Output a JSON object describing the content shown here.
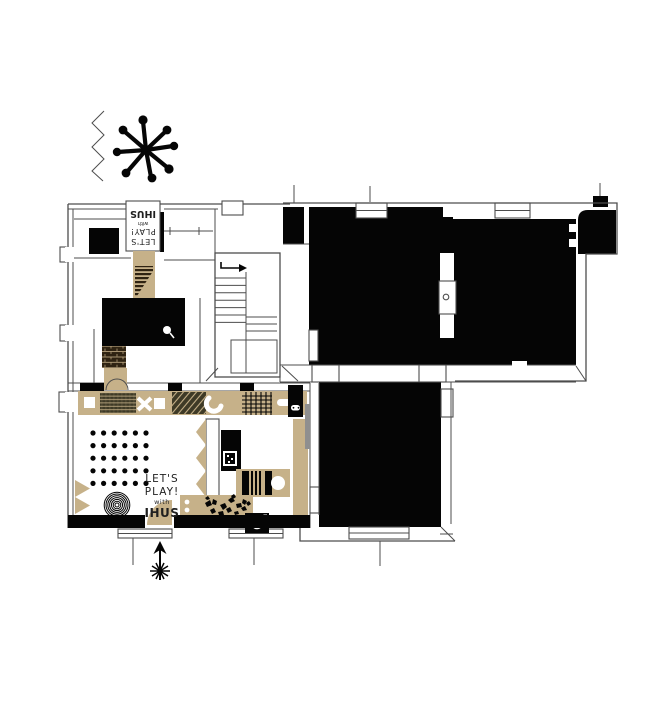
{
  "brand": {
    "lines": [
      "LET'S",
      "PLAY!",
      "with",
      "IHUS"
    ]
  },
  "colors": {
    "paper": "#ffffff",
    "ink": "#050505",
    "wall": "#4d4d4d",
    "tan": "#c6b189",
    "dark_brown": "#2f2312",
    "olive": "#3e3a26",
    "door_gray": "#8f8f8f",
    "text_ink": "#1f1f1f"
  },
  "icons": {
    "decoration_top_left": [
      "zigzag-line",
      "sputnik-star"
    ],
    "entrance": "hand-drawn-arrow-up",
    "stairs": "direction-arrow-right",
    "play_wall": "game-controller",
    "music_corner": "record-player",
    "dark_room": "lamp"
  }
}
